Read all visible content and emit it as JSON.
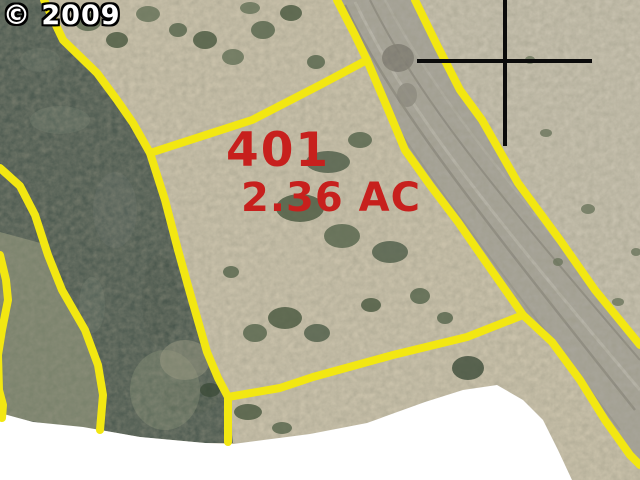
{
  "copyright_label": "© 2009",
  "parcel": {
    "number": "401",
    "area": "2.36 AC"
  },
  "colors": {
    "boundary_yellow": "#F2E712",
    "parcel_label_red": "#C7201D",
    "copyright_text": "#FFFFFF",
    "copyright_outline": "#000000",
    "crosshair_black": "#0B0B0B",
    "no_data_white": "#FFFFFF"
  },
  "map_lines": {
    "stroke_width": 8,
    "lines": [
      {
        "name": "riverbank-parcel-west-boundary-line",
        "points": [
          [
            44,
            0
          ],
          [
            63,
            40
          ],
          [
            97,
            73
          ],
          [
            117,
            100
          ],
          [
            133,
            123
          ],
          [
            150,
            153
          ],
          [
            165,
            200
          ],
          [
            178,
            250
          ],
          [
            192,
            300
          ],
          [
            207,
            352
          ],
          [
            218,
            378
          ],
          [
            228,
            397
          ],
          [
            228,
            442
          ]
        ]
      },
      {
        "name": "parcel-north-boundary-line",
        "points": [
          [
            150,
            153
          ],
          [
            252,
            120
          ],
          [
            320,
            85
          ],
          [
            367,
            60
          ]
        ]
      },
      {
        "name": "parcel-south-boundary-line",
        "points": [
          [
            228,
            397
          ],
          [
            280,
            388
          ],
          [
            313,
            377
          ],
          [
            393,
            355
          ],
          [
            467,
            337
          ],
          [
            523,
            315
          ]
        ]
      },
      {
        "name": "road-west-boundary-line",
        "points": [
          [
            337,
            0
          ],
          [
            355,
            35
          ],
          [
            367,
            60
          ],
          [
            387,
            107
          ],
          [
            405,
            150
          ],
          [
            430,
            185
          ],
          [
            458,
            222
          ],
          [
            490,
            268
          ],
          [
            523,
            315
          ],
          [
            552,
            342
          ],
          [
            580,
            380
          ],
          [
            605,
            420
          ],
          [
            630,
            455
          ],
          [
            640,
            465
          ]
        ]
      },
      {
        "name": "road-east-boundary-line",
        "points": [
          [
            415,
            0
          ],
          [
            437,
            45
          ],
          [
            460,
            90
          ],
          [
            482,
            120
          ],
          [
            518,
            183
          ],
          [
            560,
            240
          ],
          [
            595,
            290
          ],
          [
            640,
            345
          ]
        ]
      },
      {
        "name": "west-bank-boundary-line",
        "points": [
          [
            0,
            168
          ],
          [
            20,
            186
          ],
          [
            35,
            215
          ],
          [
            48,
            255
          ],
          [
            62,
            290
          ],
          [
            85,
            330
          ],
          [
            98,
            365
          ],
          [
            103,
            395
          ],
          [
            100,
            430
          ]
        ]
      },
      {
        "name": "far-left-boundary-line",
        "points": [
          [
            0,
            255
          ],
          [
            6,
            280
          ],
          [
            8,
            300
          ],
          [
            2,
            330
          ],
          [
            -2,
            355
          ],
          [
            -1,
            390
          ],
          [
            3,
            405
          ],
          [
            2,
            418
          ]
        ]
      }
    ]
  },
  "crosshair": {
    "stroke_width": 4,
    "vertical": [
      [
        505,
        0
      ],
      [
        505,
        146
      ]
    ],
    "horizontal": [
      [
        417,
        61
      ],
      [
        592,
        61
      ]
    ]
  }
}
